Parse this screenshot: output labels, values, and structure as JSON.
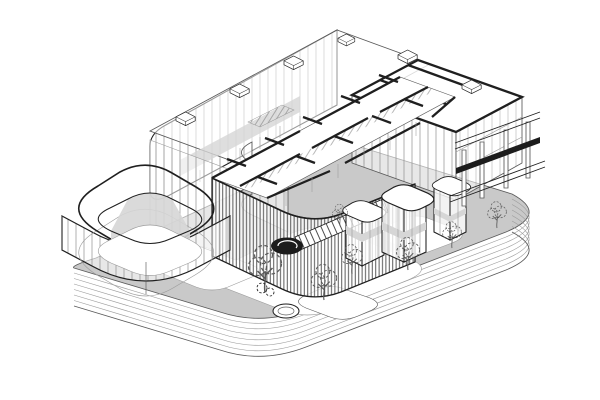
{
  "meta": {
    "title": "Axonometric architectural drawing",
    "description": "Black-and-white axonometric cutaway line drawing of a building complex: a glass hall with roof vents, an east wing with heavy cut walls, a cut-away floor plan, a louvered ground-floor facade with exterior stair and spiral landing, a rounded-square glass courtyard pavilion, framed kiosk towers and a pergola, trees and a round pond on a grey plaza, all sitting on a stepped podium of stacked rounded slabs."
  },
  "colors": {
    "paper": "#ffffff",
    "ink": "#1f1f1f",
    "line_medium": "#5a5a5a",
    "line_light": "#9c9c9c",
    "plaza_gray": "#c9c9c9",
    "wall_shade": "#d6d6d6",
    "glass_mullion": "#8f8f8f",
    "louver_dark": "#474747",
    "beam_dark": "#1c1c1c"
  },
  "components": [
    {
      "id": "podium",
      "label": "Stepped podium of stacked rounded slabs"
    },
    {
      "id": "plaza",
      "label": "Grey plaza deck with white rounded paths"
    },
    {
      "id": "glass-hall",
      "label": "Rear glass hall with mullioned curtain wall and roof vents"
    },
    {
      "id": "east-wing",
      "label": "East wing with heavy cut parapet walls and glass rooms"
    },
    {
      "id": "floor-plan",
      "label": "Cut-away upper floor plan with black partition walls"
    },
    {
      "id": "louver-facade",
      "label": "Ground floor wrapped in dense vertical louvers"
    },
    {
      "id": "exterior-stair",
      "label": "Exterior stair with dark spiral landing"
    },
    {
      "id": "courtyard-pavilion",
      "label": "Rounded-square glass pavilion with inner courtyard"
    },
    {
      "id": "kiosk-towers",
      "label": "Framed kiosk towers with rounded slab caps"
    },
    {
      "id": "pergola",
      "label": "Column-and-beam pergola frame with dark beam"
    },
    {
      "id": "landscape",
      "label": "Line-drawn trees, bushes and a round pond"
    }
  ]
}
